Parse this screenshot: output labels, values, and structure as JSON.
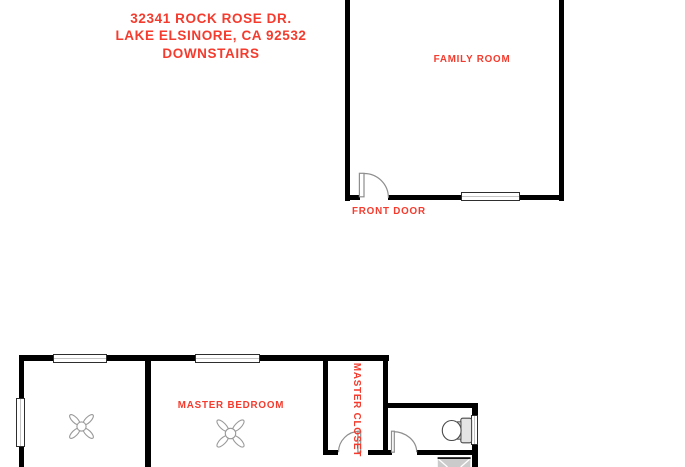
{
  "colors": {
    "accent": "#f43b2d",
    "wall": "#000000",
    "fixture": "#8e8e8e"
  },
  "address": {
    "line1": "32341 ROCK ROSE DR.",
    "line2": "LAKE ELSINORE, CA 92532",
    "line3": "DOWNSTAIRS"
  },
  "rooms": {
    "family_room": "FAMILY ROOM",
    "front_door": "FRONT DOOR",
    "master_bedroom": "MASTER BEDROOM",
    "master_closet": "MASTER CLOSET"
  }
}
